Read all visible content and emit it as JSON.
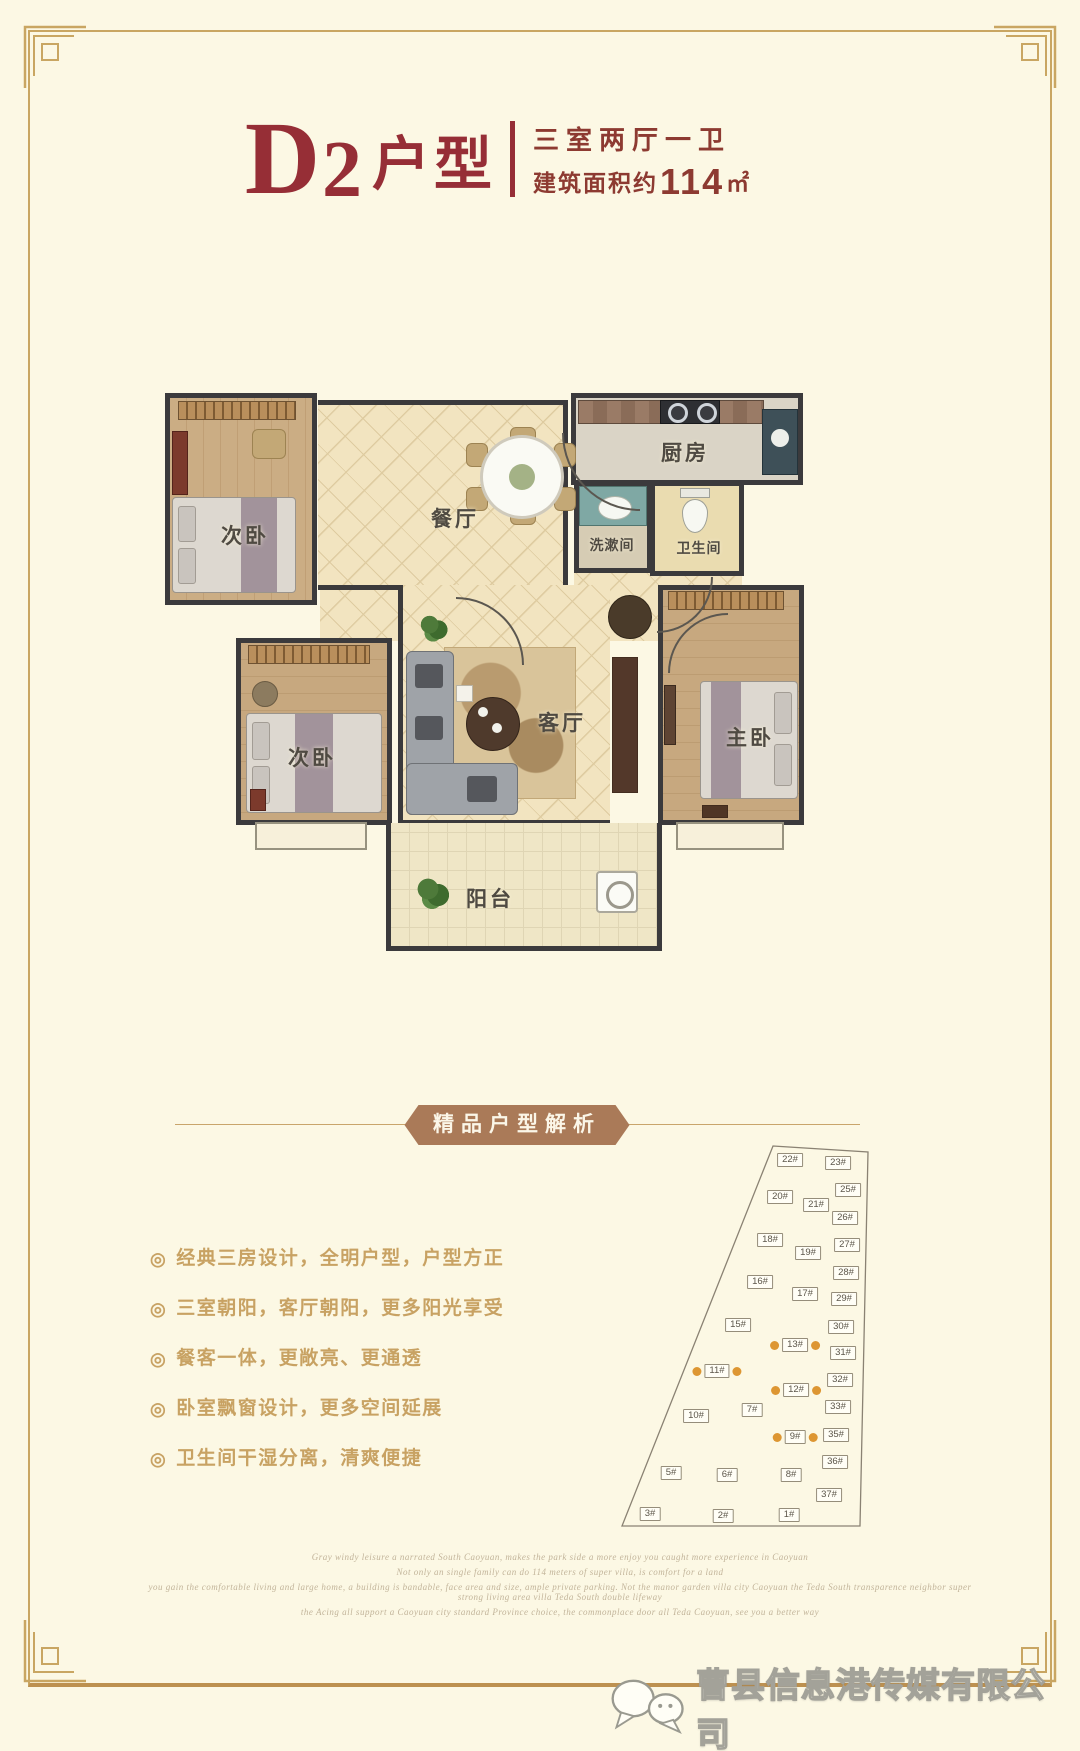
{
  "header": {
    "unit_letter": "D",
    "unit_number": "2",
    "unit_suffix": "户型",
    "spec": "三室两厅一卫",
    "area_prefix": "建筑面积约",
    "area_value": "114",
    "area_unit": "㎡"
  },
  "floorplan": {
    "rooms": [
      {
        "key": "bedroom-top",
        "label": "次卧"
      },
      {
        "key": "dining",
        "label": "餐厅"
      },
      {
        "key": "kitchen",
        "label": "厨房"
      },
      {
        "key": "washroom",
        "label": "洗漱间"
      },
      {
        "key": "bathroom",
        "label": "卫生间"
      },
      {
        "key": "living",
        "label": "客厅"
      },
      {
        "key": "master",
        "label": "主卧"
      },
      {
        "key": "bedroom-bottom",
        "label": "次卧"
      },
      {
        "key": "balcony",
        "label": "阳台"
      }
    ]
  },
  "analysis": {
    "banner": "精品户型解析",
    "bullet_icon": "◎",
    "bullets": [
      "经典三房设计，全明户型，户型方正",
      "三室朝阳，客厅朝阳，更多阳光享受",
      "餐客一体，更敞亮、更通透",
      "卧室飘窗设计，更多空间延展",
      "卫生间干湿分离，清爽便捷"
    ]
  },
  "siteplan": {
    "buildings": [
      {
        "label": "22#",
        "x": 192,
        "y": 32,
        "hl": false
      },
      {
        "label": "23#",
        "x": 240,
        "y": 35,
        "hl": false
      },
      {
        "label": "25#",
        "x": 250,
        "y": 62,
        "hl": false
      },
      {
        "label": "20#",
        "x": 182,
        "y": 69,
        "hl": false
      },
      {
        "label": "21#",
        "x": 218,
        "y": 77,
        "hl": false
      },
      {
        "label": "26#",
        "x": 247,
        "y": 90,
        "hl": false
      },
      {
        "label": "18#",
        "x": 172,
        "y": 112,
        "hl": false
      },
      {
        "label": "27#",
        "x": 249,
        "y": 117,
        "hl": false
      },
      {
        "label": "19#",
        "x": 210,
        "y": 125,
        "hl": false
      },
      {
        "label": "28#",
        "x": 248,
        "y": 145,
        "hl": false
      },
      {
        "label": "16#",
        "x": 162,
        "y": 154,
        "hl": false
      },
      {
        "label": "17#",
        "x": 207,
        "y": 166,
        "hl": false
      },
      {
        "label": "29#",
        "x": 246,
        "y": 171,
        "hl": false
      },
      {
        "label": "15#",
        "x": 140,
        "y": 197,
        "hl": false
      },
      {
        "label": "30#",
        "x": 243,
        "y": 199,
        "hl": false
      },
      {
        "label": "13#",
        "x": 197,
        "y": 217,
        "hl": true
      },
      {
        "label": "31#",
        "x": 245,
        "y": 225,
        "hl": false
      },
      {
        "label": "11#",
        "x": 119,
        "y": 243,
        "hl": true
      },
      {
        "label": "32#",
        "x": 242,
        "y": 252,
        "hl": false
      },
      {
        "label": "12#",
        "x": 198,
        "y": 262,
        "hl": true
      },
      {
        "label": "33#",
        "x": 240,
        "y": 279,
        "hl": false
      },
      {
        "label": "7#",
        "x": 154,
        "y": 282,
        "hl": false
      },
      {
        "label": "10#",
        "x": 98,
        "y": 288,
        "hl": false
      },
      {
        "label": "35#",
        "x": 238,
        "y": 307,
        "hl": false
      },
      {
        "label": "9#",
        "x": 197,
        "y": 309,
        "hl": true
      },
      {
        "label": "36#",
        "x": 237,
        "y": 334,
        "hl": false
      },
      {
        "label": "5#",
        "x": 73,
        "y": 345,
        "hl": false
      },
      {
        "label": "6#",
        "x": 129,
        "y": 347,
        "hl": false
      },
      {
        "label": "8#",
        "x": 193,
        "y": 347,
        "hl": false
      },
      {
        "label": "37#",
        "x": 231,
        "y": 367,
        "hl": false
      },
      {
        "label": "3#",
        "x": 52,
        "y": 386,
        "hl": false
      },
      {
        "label": "2#",
        "x": 125,
        "y": 388,
        "hl": false
      },
      {
        "label": "1#",
        "x": 191,
        "y": 387,
        "hl": false
      }
    ]
  },
  "footer": {
    "script_lines": [
      "Gray windy leisure a narrated South Caoyuan, makes the park side a more enjoy you caught more experience in Caoyuan",
      "Not only an single family can do 114 meters of super villa, is comfort for a land",
      "you gain the comfortable living and large home, a building is bandable, face area and size, ample private parking. Not the manor garden villa city Caoyuan the Teda South transparence neighbor super strong living area villa Teda South double lifeway",
      "the Acing all support a Caoyuan city standard Province choice, the commonplace door all Teda Caoyuan, see you a better way"
    ],
    "watermark": "曹县信息港传媒有限公司"
  },
  "colors": {
    "accent_maroon": "#962E36",
    "banner_brown": "#AA7A58",
    "bullet_gold": "#C8A263",
    "highlight_orange": "#DD9632",
    "frame_gold": "#C9A662",
    "background_cream": "#FCF8E4"
  }
}
